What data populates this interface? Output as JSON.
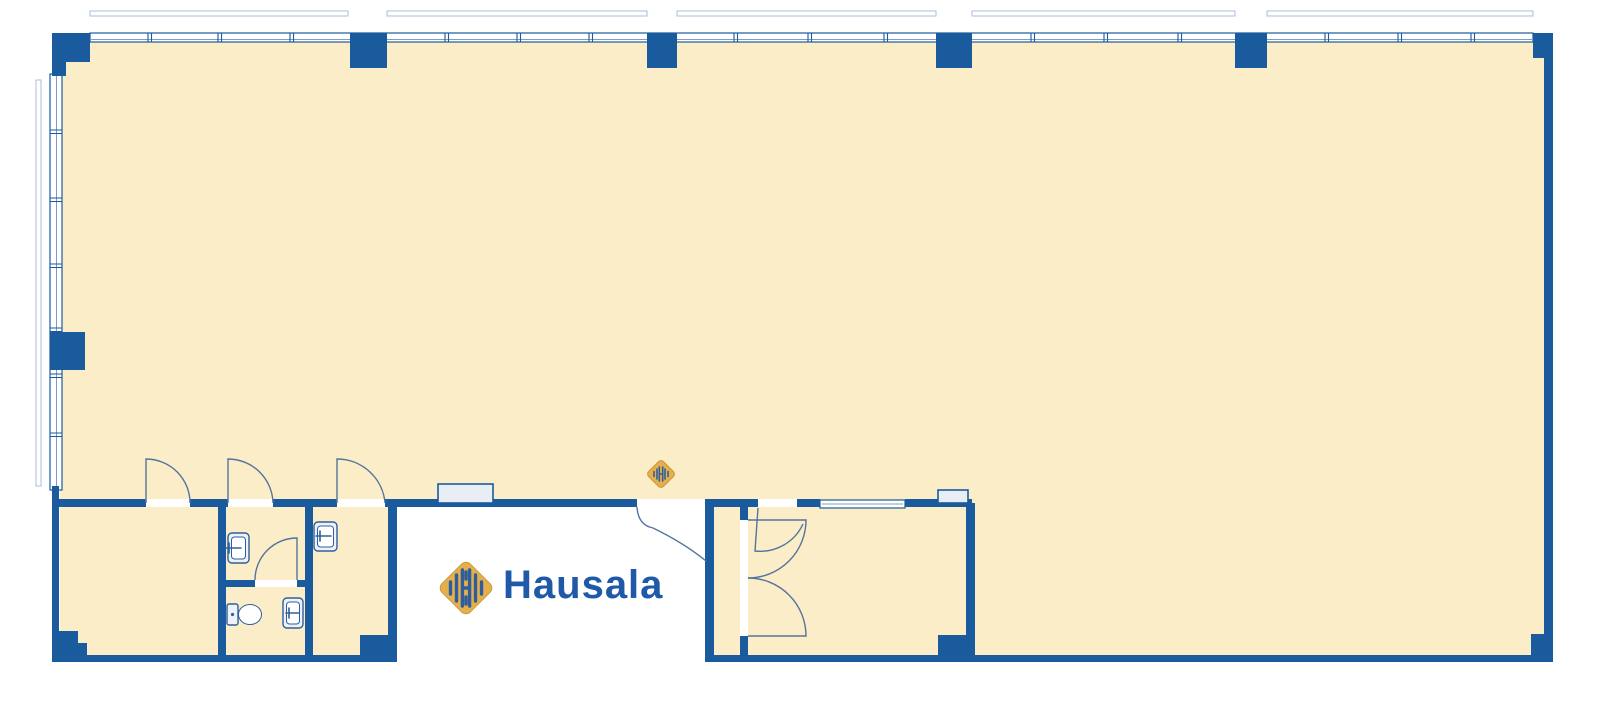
{
  "page": {
    "background": "#FFFFFF",
    "description": "Architectural floor plan of an open commercial space with continuous window walls on the top and left, a restroom block at lower left, a recessed main entrance at bottom center and an enclosed room at lower right"
  },
  "logo": {
    "text": "Hausala"
  },
  "colors": {
    "wall": "#1A5B9D",
    "floor": "#FBEDC7",
    "window-fill": "#FFFFFF",
    "inner-glass": "#7C9CC4",
    "sill": "#A9BDD8",
    "door": "#54749E",
    "panel-fill": "#E9EEF6",
    "fixture-stroke": "#2F5E9E",
    "fixture-fill": "#EDF2F8",
    "gold": "#E5B04C",
    "gold-border": "#C9983B",
    "logo-blue": "#1E5AA8"
  },
  "floor_plan": {
    "rooms": [
      "main-hall",
      "left-room",
      "restroom",
      "side-room",
      "right-room"
    ],
    "fixtures": [
      "sink",
      "sink",
      "toilet",
      "sink"
    ],
    "doors": [
      "left-room-door",
      "restroom-door",
      "side-room-door",
      "restroom-inner-door",
      "main-entrance-door",
      "right-room-door",
      "right-room-double-door"
    ],
    "features": [
      "top-window-wall",
      "left-window-wall",
      "wall-pillars",
      "wall-panels",
      "corner-columns",
      "entrance-logo-marker"
    ]
  }
}
